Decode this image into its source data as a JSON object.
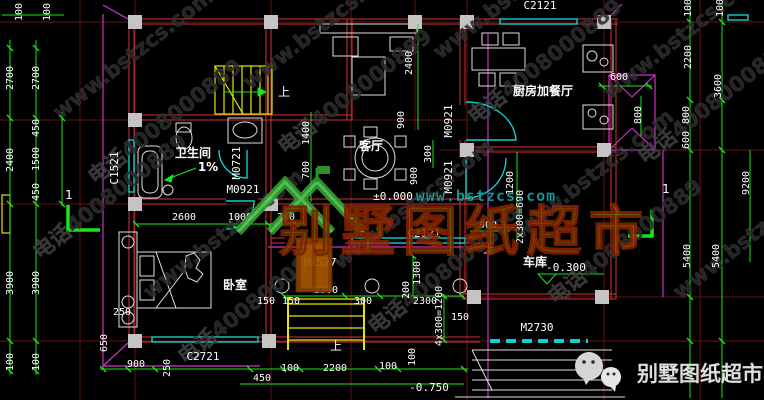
{
  "watermark": {
    "site": "www.bstzcs.com",
    "phone": "电话4008000889",
    "tiles": [
      {
        "t": "www.bstzcs.com",
        "x": 60,
        "y": 120
      },
      {
        "t": "电话4008000889",
        "x": 95,
        "y": 185
      },
      {
        "t": "www.bstzcs.com",
        "x": 150,
        "y": 300
      },
      {
        "t": "电话4008000889",
        "x": 185,
        "y": 365
      },
      {
        "t": "www.bstzcs.com",
        "x": 250,
        "y": 90
      },
      {
        "t": "电话4008000889",
        "x": 285,
        "y": 155
      },
      {
        "t": "www.bstzcs.com",
        "x": 340,
        "y": 270
      },
      {
        "t": "电话4008000889",
        "x": 375,
        "y": 335
      },
      {
        "t": "www.bstzcs.com",
        "x": 440,
        "y": 60
      },
      {
        "t": "电话4008000889",
        "x": 475,
        "y": 125
      },
      {
        "t": "www.bstzcs.com",
        "x": 520,
        "y": 240
      },
      {
        "t": "电话4008000889",
        "x": 555,
        "y": 305
      },
      {
        "t": "www.bstzcs.com",
        "x": 610,
        "y": 100
      },
      {
        "t": "电话4008000889",
        "x": 645,
        "y": 165
      },
      {
        "t": "www.bstzcs.com",
        "x": 680,
        "y": 300
      },
      {
        "t": "电话4008000889",
        "x": 40,
        "y": 260
      }
    ]
  },
  "brand": {
    "title": "别墅图纸超市",
    "url": "www.bstzcs.com"
  },
  "footer": {
    "text": "别墅图纸超市"
  },
  "colors": {
    "dimension": "#19e619",
    "axis": "#8b1515",
    "wall": "#d23232",
    "window": "#0fd0d0",
    "stair": "#e6e600",
    "highlight": "#cc33cc",
    "column": "#c4c4c4",
    "brand_gold": "#7d6b00",
    "brand_teal": "#18b8b8"
  },
  "annotations": {
    "rooms": [
      {
        "t": "客厅",
        "x": 371,
        "y": 150
      },
      {
        "t": "卫生间",
        "x": 193,
        "y": 157
      },
      {
        "t": "1%",
        "x": 208,
        "y": 171
      },
      {
        "t": "厨房加餐厅",
        "x": 543,
        "y": 95
      },
      {
        "t": "卧室",
        "x": 235,
        "y": 289
      },
      {
        "t": "车库",
        "x": 535,
        "y": 266
      }
    ],
    "tags_h": [
      {
        "t": "C2121",
        "x": 540,
        "y": 9
      },
      {
        "t": "C2121",
        "x": 424,
        "y": 237
      },
      {
        "t": "C2721",
        "x": 203,
        "y": 360
      },
      {
        "t": "M0921",
        "x": 243,
        "y": 193
      },
      {
        "t": "M1527",
        "x": 320,
        "y": 266
      },
      {
        "t": "M2730",
        "x": 537,
        "y": 331
      }
    ],
    "tags_v": [
      {
        "t": "C1521",
        "x": 118,
        "y": 168
      },
      {
        "t": "M0721",
        "x": 240,
        "y": 163
      },
      {
        "t": "M0921",
        "x": 452,
        "y": 121
      },
      {
        "t": "M0921",
        "x": 452,
        "y": 177
      }
    ],
    "dims_h": [
      {
        "t": "600",
        "x": 619,
        "y": 80
      },
      {
        "t": "2600",
        "x": 184,
        "y": 220
      },
      {
        "t": "1000",
        "x": 240,
        "y": 220
      },
      {
        "t": "300",
        "x": 286,
        "y": 220
      },
      {
        "t": "2300",
        "x": 326,
        "y": 293
      },
      {
        "t": "300",
        "x": 363,
        "y": 304
      },
      {
        "t": "2300",
        "x": 425,
        "y": 304
      },
      {
        "t": "150",
        "x": 291,
        "y": 304
      },
      {
        "t": "150",
        "x": 266,
        "y": 304
      },
      {
        "t": "150",
        "x": 460,
        "y": 320
      },
      {
        "t": "900",
        "x": 488,
        "y": 228
      },
      {
        "t": "900",
        "x": 136,
        "y": 367
      },
      {
        "t": "250",
        "x": 122,
        "y": 315
      },
      {
        "t": "450",
        "x": 262,
        "y": 381
      },
      {
        "t": "100",
        "x": 290,
        "y": 371
      },
      {
        "t": "2200",
        "x": 335,
        "y": 371
      },
      {
        "t": "100",
        "x": 388,
        "y": 369
      }
    ],
    "dims_v": [
      {
        "t": "100",
        "x": 22,
        "y": 12
      },
      {
        "t": "100",
        "x": 50,
        "y": 12
      },
      {
        "t": "2700",
        "x": 13,
        "y": 78
      },
      {
        "t": "2700",
        "x": 39,
        "y": 78
      },
      {
        "t": "2400",
        "x": 13,
        "y": 160
      },
      {
        "t": "450",
        "x": 39,
        "y": 128
      },
      {
        "t": "1500",
        "x": 39,
        "y": 159
      },
      {
        "t": "450",
        "x": 39,
        "y": 192
      },
      {
        "t": "3900",
        "x": 13,
        "y": 283
      },
      {
        "t": "3900",
        "x": 39,
        "y": 283
      },
      {
        "t": "100",
        "x": 13,
        "y": 362
      },
      {
        "t": "100",
        "x": 39,
        "y": 362
      },
      {
        "t": "650",
        "x": 107,
        "y": 343
      },
      {
        "t": "250",
        "x": 170,
        "y": 368
      },
      {
        "t": "1400",
        "x": 309,
        "y": 133
      },
      {
        "t": "700",
        "x": 309,
        "y": 170
      },
      {
        "t": "2400",
        "x": 412,
        "y": 63
      },
      {
        "t": "900",
        "x": 404,
        "y": 120
      },
      {
        "t": "900",
        "x": 417,
        "y": 176
      },
      {
        "t": "300",
        "x": 431,
        "y": 154
      },
      {
        "t": "1200",
        "x": 513,
        "y": 183
      },
      {
        "t": "2x300=600",
        "x": 523,
        "y": 217
      },
      {
        "t": "200",
        "x": 409,
        "y": 290
      },
      {
        "t": "1300",
        "x": 420,
        "y": 273
      },
      {
        "t": "4x300=1200",
        "x": 442,
        "y": 316
      },
      {
        "t": "100",
        "x": 415,
        "y": 357
      },
      {
        "t": "600",
        "x": 689,
        "y": 140
      },
      {
        "t": "800",
        "x": 641,
        "y": 115
      },
      {
        "t": "800",
        "x": 689,
        "y": 115
      },
      {
        "t": "2200",
        "x": 691,
        "y": 57
      },
      {
        "t": "3600",
        "x": 721,
        "y": 86
      },
      {
        "t": "100",
        "x": 691,
        "y": 8
      },
      {
        "t": "100",
        "x": 723,
        "y": 8
      },
      {
        "t": "5400",
        "x": 690,
        "y": 256
      },
      {
        "t": "5400",
        "x": 719,
        "y": 256
      },
      {
        "t": "9200",
        "x": 749,
        "y": 183
      }
    ],
    "levels": [
      {
        "t": "±0.000",
        "x": 393,
        "y": 200
      },
      {
        "t": "-0.300",
        "x": 566,
        "y": 271
      },
      {
        "t": "-0.750",
        "x": 429,
        "y": 391
      }
    ],
    "marks": [
      {
        "t": "上",
        "x": 284,
        "y": 96
      },
      {
        "t": "上",
        "x": 489,
        "y": 253
      },
      {
        "t": "上",
        "x": 336,
        "y": 350
      },
      {
        "t": "1",
        "x": 69,
        "y": 199
      },
      {
        "t": "1",
        "x": 666,
        "y": 193
      }
    ]
  }
}
